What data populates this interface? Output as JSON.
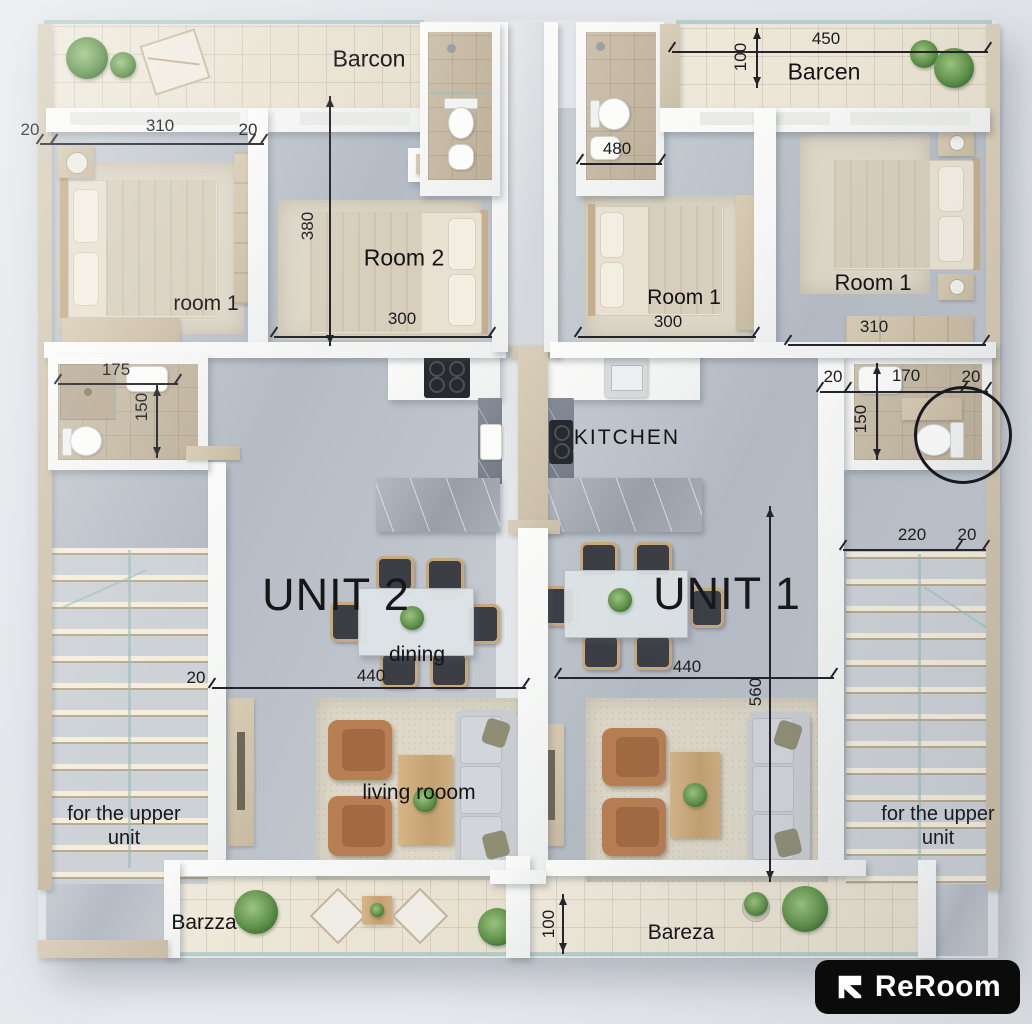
{
  "title": "Two-unit apartment floor plan",
  "units": {
    "unit1": "UNIT 1",
    "unit2": "UNIT 2"
  },
  "rooms": {
    "barcon": "Barcon",
    "barcen": "Barcen",
    "room1_lower": "room 1",
    "room2": "Room 2",
    "room1": "Room 1",
    "kitchen": "KITCHEN",
    "dining": "dining",
    "living_room": "living rooom",
    "upper_unit": "for the upper unit",
    "barzza": "Barzza",
    "bareza": "Bareza"
  },
  "dims": {
    "d20": "20",
    "d100": "100",
    "d150": "150",
    "d170": "170",
    "d175": "175",
    "d220": "220",
    "d300": "300",
    "d310": "310",
    "d380": "380",
    "d440": "440",
    "d450": "450",
    "d480": "480",
    "d560": "560"
  },
  "logo": {
    "brand": "ReRoom"
  },
  "colors": {
    "annotation": "#23232a",
    "wall": "#f7f8f7",
    "wall_cap": "#d0c5b0",
    "balcony_tile": "#eae3d4",
    "floor": "#bcc2ca",
    "bath_floor": "#c3b7a2",
    "wood": "#c9a87e",
    "armchair": "#b87e54",
    "sofa": "#c9cdd2",
    "logo_bg": "#0b0b0b",
    "logo_fg": "#ffffff"
  }
}
